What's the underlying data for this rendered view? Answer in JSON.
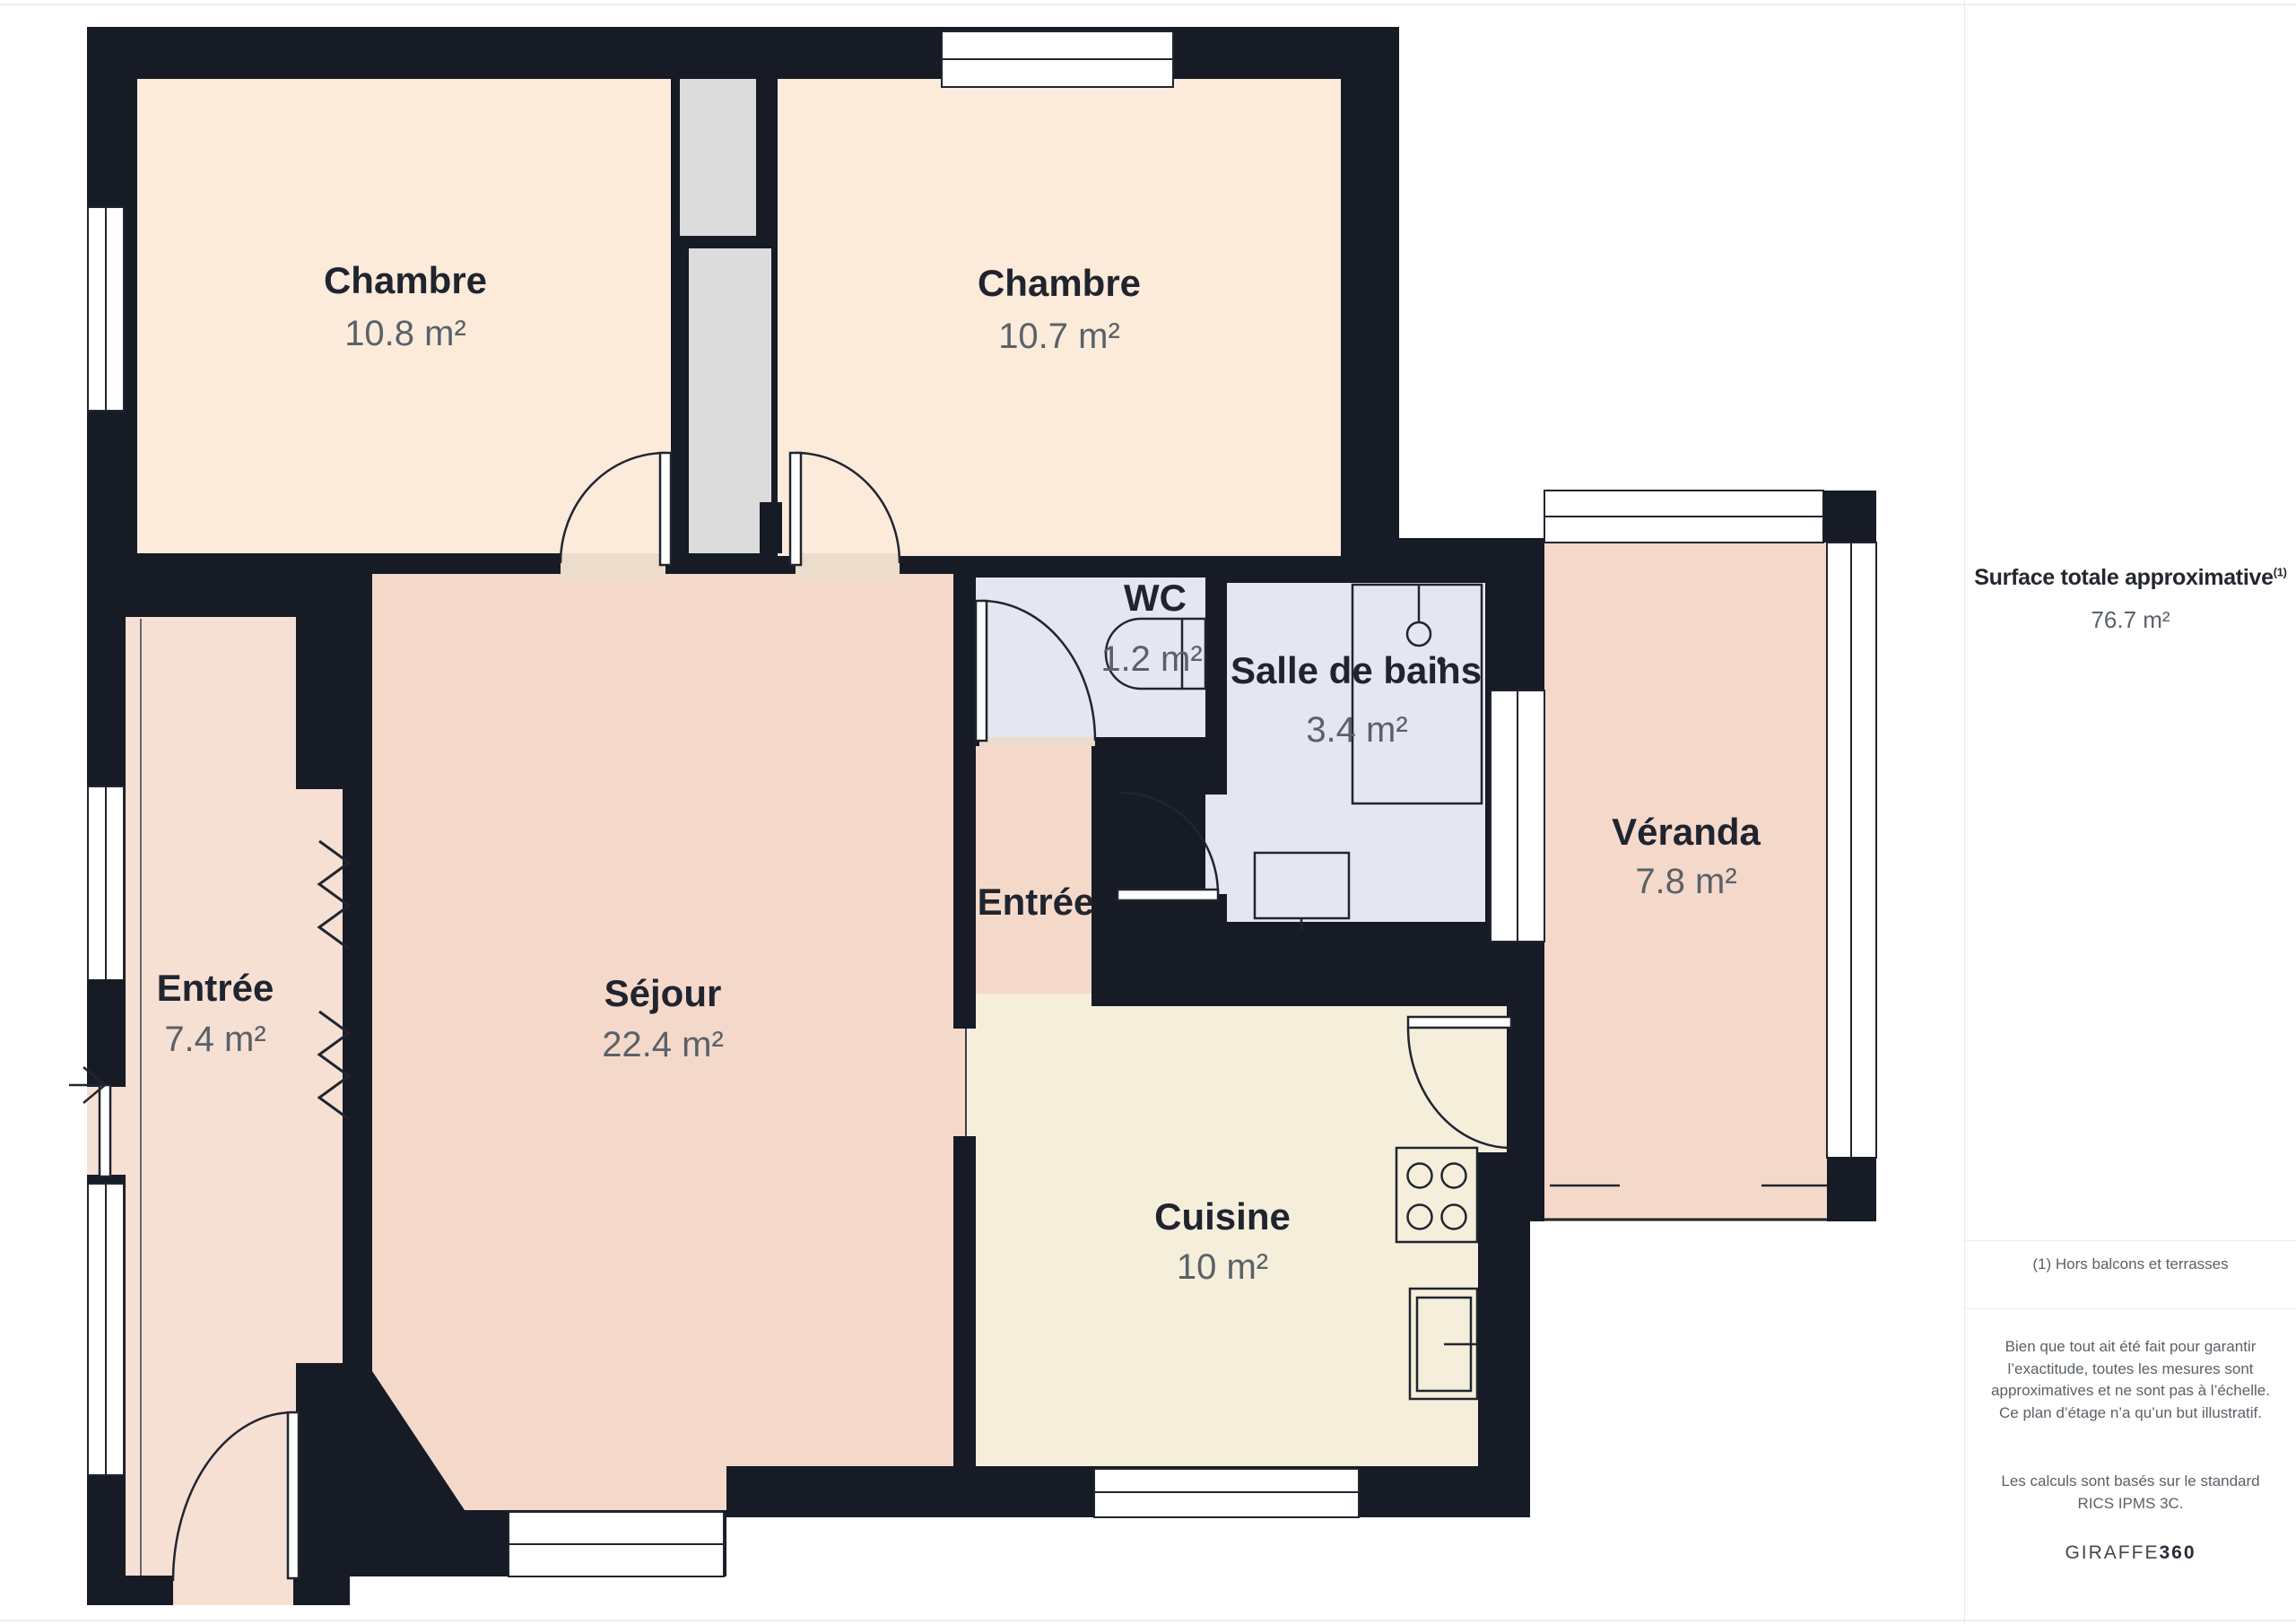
{
  "plan": {
    "rooms": [
      {
        "id": "chambre-1",
        "name": "Chambre",
        "area": "10.8 m²"
      },
      {
        "id": "chambre-2",
        "name": "Chambre",
        "area": "10.7 m²"
      },
      {
        "id": "wc",
        "name": "WC",
        "area": "1.2 m²"
      },
      {
        "id": "salle-de-bains",
        "name": "Salle de bains",
        "area": "3.4 m²"
      },
      {
        "id": "veranda",
        "name": "Véranda",
        "area": "7.8 m²"
      },
      {
        "id": "entree-gauche",
        "name": "Entrée",
        "area": "7.4 m²"
      },
      {
        "id": "sejour",
        "name": "Séjour",
        "area": "22.4 m²"
      },
      {
        "id": "entree-milieu",
        "name": "Entrée",
        "area": ""
      },
      {
        "id": "cuisine",
        "name": "Cuisine",
        "area": "10 m²"
      }
    ],
    "palette": {
      "wall": "#161B26",
      "bedroom_floor": "#FCEBDB",
      "living_floor": "#F4D9CB",
      "hall_floor": "#F6DFD3",
      "kitchen_floor": "#F4EEDB",
      "bathroom_floor": "#E4E6F1",
      "closet_floor": "#DBDCDB",
      "threshold": "#EBDCCB",
      "label_text": "#20242E",
      "muted_text": "#5A6168"
    }
  },
  "sidebar": {
    "title": "Surface totale approximative",
    "title_superscript": "(1)",
    "total_area": "76.7 m²",
    "footnote": "(1) Hors balcons et terrasses",
    "disclaimer": "Bien que tout ait été fait pour garantir l’exactitude, toutes les mesures sont approximatives et ne sont pas à l’échelle. Ce plan d’étage n’a qu’un but illustratif.",
    "standard_note": "Les calculs sont basés sur le standard RICS IPMS 3C.",
    "brand": {
      "name": "GIRAFFE",
      "suffix": "360"
    }
  }
}
